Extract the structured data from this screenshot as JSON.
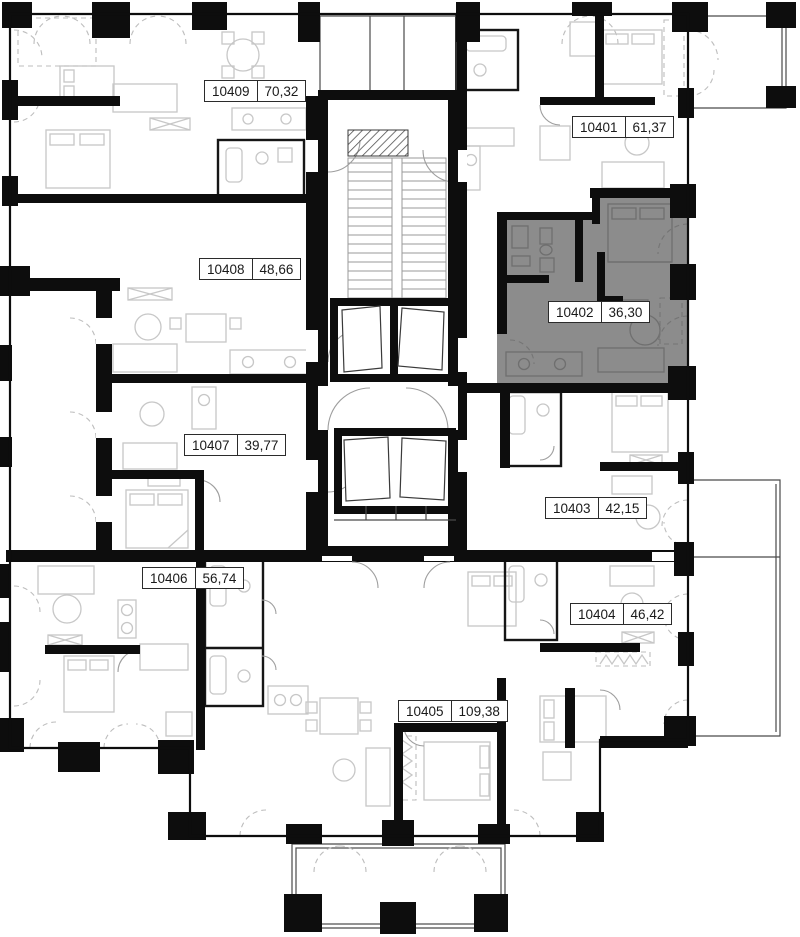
{
  "plan": {
    "type": "floor-plan",
    "highlighted_unit": "10402",
    "units": [
      {
        "id": "10401",
        "area": "61,37",
        "highlighted": false
      },
      {
        "id": "10402",
        "area": "36,30",
        "highlighted": true
      },
      {
        "id": "10403",
        "area": "42,15",
        "highlighted": false
      },
      {
        "id": "10404",
        "area": "46,42",
        "highlighted": false
      },
      {
        "id": "10405",
        "area": "109,38",
        "highlighted": false
      },
      {
        "id": "10406",
        "area": "56,74",
        "highlighted": false
      },
      {
        "id": "10407",
        "area": "39,77",
        "highlighted": false
      },
      {
        "id": "10408",
        "area": "48,66",
        "highlighted": false
      },
      {
        "id": "10409",
        "area": "70,32",
        "highlighted": false
      }
    ],
    "colors": {
      "background": "#ffffff",
      "walls": "#0d0d0d",
      "furniture_lines": "#c7c7c7",
      "highlight_fill": "#8c8c8c",
      "highlight_furniture": "#6f6f6f",
      "label_border": "#2b2b2b",
      "label_text": "#1a1a1a"
    }
  }
}
